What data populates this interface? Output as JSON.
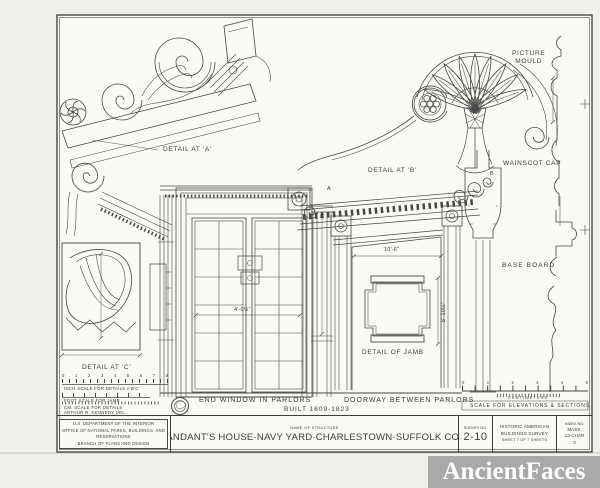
{
  "watermark": {
    "text": "AncientFaces"
  },
  "drawing_labels": {
    "detail_a": "DETAIL AT 'A'",
    "detail_b": "DETAIL AT 'B'",
    "detail_c": "DETAIL AT 'C'",
    "detail_of_jamb": "DETAIL OF JAMB",
    "picture_mould": "PICTURE\nMOULD",
    "wainscot_cap": "WAINSCOT CAP",
    "base_board": "BASE BOARD",
    "end_window": "END WINDOW IN PARLORS",
    "doorway": "DOORWAY BETWEEN PARLORS",
    "built": "BUILT 1809-1823"
  },
  "markers": {
    "a": "A",
    "b": "B",
    "c": "C"
  },
  "dimensions": {
    "doorway_width": "10'-6\"",
    "doorway_height": "6'-10½\"",
    "window_width": "4'-0½\""
  },
  "scale_bars": {
    "inch_numbers": [
      "0",
      "1",
      "2",
      "3",
      "4",
      "5",
      "6",
      "7",
      "8"
    ],
    "inch_label": "INCH SCALE FOR DETAILS A'B'C'",
    "foot_label": "FOOT SCALE FOR JAMB",
    "cm_label": "CM. SCALE FOR DETAILS",
    "delineator": "ARTHUR R. KENNEDY   DEL.",
    "elev_numbers": [
      "0",
      "1",
      "2",
      "3",
      "4",
      "5"
    ],
    "centimeters": "CENTIMETERS",
    "elev_label": "SCALE FOR ELEVATIONS & SECTIONS"
  },
  "title_block": {
    "agency_line1": "U.S. DEPARTMENT OF THE INTERIOR",
    "agency_line2": "OFFICE OF NATIONAL PARKS, BUILDINGS, AND RESERVATIONS",
    "agency_line3": "BRANCH OF PLANS AND DESIGN",
    "name_of_structure": "NAME OF STRUCTURE",
    "structure_name": "COMMANDANT'S HOUSE·NAVY YARD·CHARLESTOWN·SUFFOLK CO·MASS·",
    "survey_label": "SURVEY NO.",
    "survey_no": "2-10",
    "survey_org_1": "HISTORIC AMERICAN",
    "survey_org_2": "BUILDINGS SURVEY",
    "sheet_info": "SHEET 7 OF 7 SHEETS",
    "index_label": "INDEX NO.",
    "index_line1": "MASS.",
    "index_line2": "13-CHAR",
    "index_line3": "3"
  }
}
